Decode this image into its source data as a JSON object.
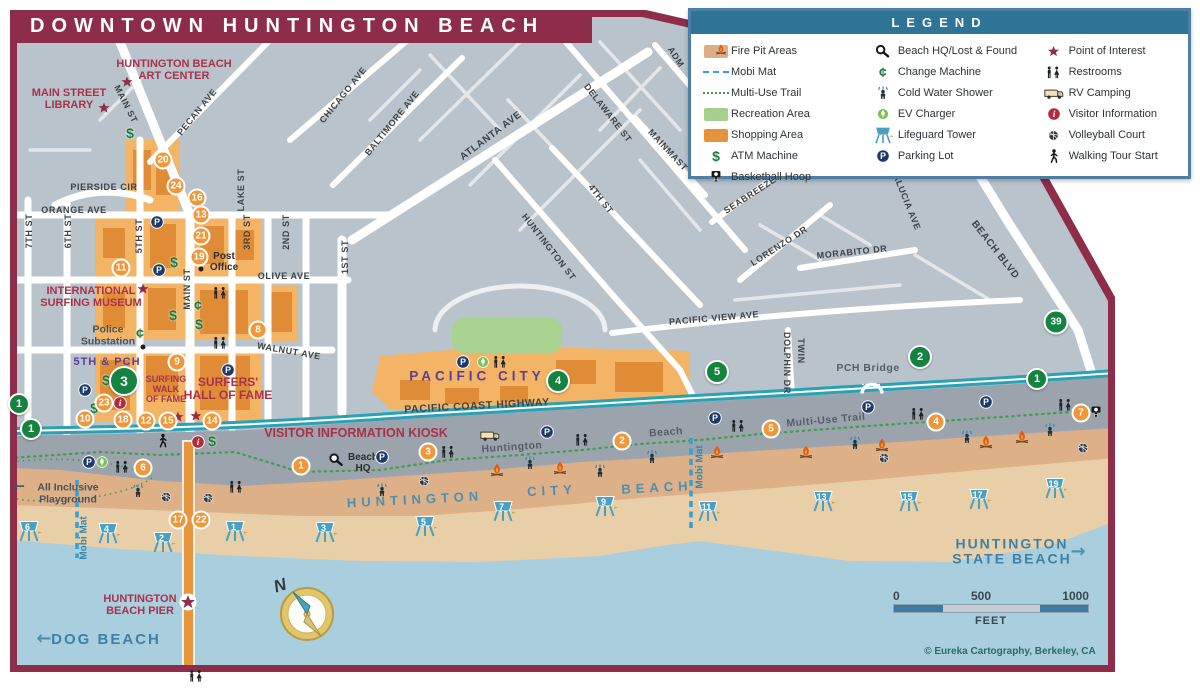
{
  "title": "DOWNTOWN HUNTINGTON BEACH",
  "legend": {
    "title": "LEGEND",
    "columns": [
      [
        {
          "icon": "sw-fire",
          "label": "Fire Pit Areas"
        },
        {
          "icon": "ln-mobi",
          "label": "Mobi Mat"
        },
        {
          "icon": "ln-trail",
          "label": "Multi-Use Trail"
        },
        {
          "icon": "sw-rec",
          "label": "Recreation Area"
        },
        {
          "icon": "sw-shop",
          "label": "Shopping Area"
        },
        {
          "icon": "atm",
          "label": "ATM Machine"
        },
        {
          "icon": "bb",
          "label": "Basketball Hoop"
        }
      ],
      [
        {
          "icon": "hq",
          "label": "Beach HQ/Lost & Found"
        },
        {
          "icon": "cent",
          "label": "Change Machine"
        },
        {
          "icon": "shower",
          "label": "Cold Water Shower"
        },
        {
          "icon": "ev",
          "label": "EV Charger"
        },
        {
          "icon": "tower",
          "label": "Lifeguard Tower"
        },
        {
          "icon": "p",
          "label": "Parking Lot"
        }
      ],
      [
        {
          "icon": "star",
          "label": "Point of Interest"
        },
        {
          "icon": "wc",
          "label": "Restrooms"
        },
        {
          "icon": "rv",
          "label": "RV Camping"
        },
        {
          "icon": "info",
          "label": "Visitor Information"
        },
        {
          "icon": "vb",
          "label": "Volleyball Court"
        },
        {
          "icon": "walk",
          "label": "Walking Tour Start"
        }
      ]
    ]
  },
  "compass": {
    "label": "N"
  },
  "scale_bar": {
    "t0": "0",
    "t500": "500",
    "t1000": "1000",
    "unit": "FEET"
  },
  "copyright": "© Eureka Cartography, Berkeley, CA",
  "map": {
    "street_labels": [
      {
        "text": "PIERSIDE CIR",
        "x": 104,
        "y": 187,
        "rot": 0
      },
      {
        "text": "ORANGE AVE",
        "x": 74,
        "y": 210,
        "rot": 0
      },
      {
        "text": "OLIVE AVE",
        "x": 284,
        "y": 276,
        "rot": 0
      },
      {
        "text": "WALNUT AVE",
        "x": 289,
        "y": 351,
        "rot": 10
      },
      {
        "text": "7TH ST",
        "x": 29,
        "y": 231,
        "rot": -90
      },
      {
        "text": "6TH ST",
        "x": 68,
        "y": 231,
        "rot": -90
      },
      {
        "text": "5TH ST",
        "x": 139,
        "y": 236,
        "rot": -90
      },
      {
        "text": "MAIN ST",
        "x": 187,
        "y": 289,
        "rot": -90
      },
      {
        "text": "LAKE ST",
        "x": 241,
        "y": 190,
        "rot": -90
      },
      {
        "text": "3RD ST",
        "x": 247,
        "y": 232,
        "rot": -90
      },
      {
        "text": "2ND ST",
        "x": 286,
        "y": 232,
        "rot": -90
      },
      {
        "text": "1ST ST",
        "x": 345,
        "y": 257,
        "rot": -90
      },
      {
        "text": "MAIN ST",
        "x": 126,
        "y": 104,
        "rot": 63
      },
      {
        "text": "PECAN AVE",
        "x": 197,
        "y": 112,
        "rot": -51
      },
      {
        "text": "CHICAGO AVE",
        "x": 343,
        "y": 95,
        "rot": -51
      },
      {
        "text": "BALTIMORE AVE",
        "x": 392,
        "y": 123,
        "rot": -51
      },
      {
        "text": "ATLANTA AVE",
        "x": 491,
        "y": 136,
        "rot": -37,
        "fs": 10
      },
      {
        "text": "DELAWARE ST",
        "x": 608,
        "y": 113,
        "rot": 52
      },
      {
        "text": "4TH ST",
        "x": 601,
        "y": 199,
        "rot": 52
      },
      {
        "text": "HUNTINGTON ST",
        "x": 549,
        "y": 247,
        "rot": 52
      },
      {
        "text": "MAINMAST",
        "x": 668,
        "y": 150,
        "rot": 47
      },
      {
        "text": "ADM",
        "x": 676,
        "y": 57,
        "rot": 57
      },
      {
        "text": "SEABREEZE",
        "x": 750,
        "y": 195,
        "rot": -33
      },
      {
        "text": "LORENZO DR",
        "x": 779,
        "y": 246,
        "rot": -33
      },
      {
        "text": "MORABITO DR",
        "x": 852,
        "y": 252,
        "rot": -6
      },
      {
        "text": "ALUCIA AVE",
        "x": 907,
        "y": 202,
        "rot": 68
      },
      {
        "text": "BEACH BLVD",
        "x": 995,
        "y": 250,
        "rot": 52,
        "fs": 10
      },
      {
        "text": "PACIFIC VIEW AVE",
        "x": 714,
        "y": 318,
        "rot": -5
      },
      {
        "text": "DOLPHIN DR",
        "x": 787,
        "y": 363,
        "rot": 90
      },
      {
        "text": "TWIN",
        "x": 801,
        "y": 351,
        "rot": 90
      },
      {
        "text": "PACIFIC COAST HIGHWAY",
        "x": 477,
        "y": 406,
        "rot": -3,
        "fs": 10.5
      }
    ],
    "place_labels": [
      {
        "text": "HUNTINGTON BEACH\nART CENTER",
        "x": 174,
        "y": 70,
        "cls": "pl-maroon",
        "fs": 11
      },
      {
        "text": "MAIN STREET\nLIBRARY",
        "x": 69,
        "y": 99,
        "cls": "pl-maroon",
        "fs": 11
      },
      {
        "text": "INTERNATIONAL\nSURFING MUSEUM",
        "x": 91,
        "y": 297,
        "cls": "pl-maroon",
        "fs": 11
      },
      {
        "text": "5TH & PCH",
        "x": 107,
        "y": 362,
        "cls": "pl-purple",
        "fs": 11
      },
      {
        "text": "SURFING\nWALK\nOF FAME",
        "x": 166,
        "y": 390,
        "cls": "pl-maroon",
        "fs": 9
      },
      {
        "text": "SURFERS'\nHALL OF FAME",
        "x": 228,
        "y": 389,
        "cls": "pl-maroon",
        "fs": 12
      },
      {
        "text": "VISITOR INFORMATION KIOSK",
        "x": 356,
        "y": 434,
        "cls": "pl-maroon",
        "fs": 12.5
      },
      {
        "text": "HUNTINGTON\nBEACH PIER",
        "x": 140,
        "y": 605,
        "cls": "pl-maroon",
        "fs": 11
      },
      {
        "text": "PACIFIC CITY",
        "x": 477,
        "y": 377,
        "cls": "pl-pc",
        "fs": 13.5
      },
      {
        "text": "Post\nOffice",
        "x": 224,
        "y": 262,
        "cls": "pl-black",
        "fs": 10
      },
      {
        "text": "Police\nSubstation",
        "x": 108,
        "y": 336,
        "cls": "pl-gray",
        "fs": 10.5
      },
      {
        "text": "Beach\nHQ",
        "x": 363,
        "y": 463,
        "cls": "pl-black",
        "fs": 10
      },
      {
        "text": "All Inclusive\nPlayground",
        "x": 68,
        "y": 494,
        "cls": "pl-gray",
        "fs": 10.5
      },
      {
        "text": "PCH Bridge",
        "x": 868,
        "y": 369,
        "cls": "pl-trail",
        "fs": 10.5
      },
      {
        "text": "Huntington",
        "x": 512,
        "y": 448,
        "cls": "pl-trail",
        "fs": 10.5,
        "rot": -4
      },
      {
        "text": "Beach",
        "x": 666,
        "y": 433,
        "cls": "pl-trail",
        "fs": 10.5,
        "rot": -4
      },
      {
        "text": "Multi-Use Trail",
        "x": 826,
        "y": 421,
        "cls": "pl-trail",
        "fs": 10.5,
        "rot": -5
      },
      {
        "text": "Mobi Mat",
        "x": 84,
        "y": 538,
        "cls": "pl-mobi",
        "fs": 10,
        "rot": -90
      },
      {
        "text": "Mobi Mat",
        "x": 700,
        "y": 467,
        "cls": "pl-mobi",
        "fs": 10,
        "rot": -90
      },
      {
        "text": "DOG BEACH",
        "x": 106,
        "y": 640,
        "cls": "pl-bluebig",
        "fs": 15
      },
      {
        "text": "HUNTINGTON\nSTATE BEACH",
        "x": 1012,
        "y": 552,
        "cls": "pl-bluebig",
        "fs": 14
      },
      {
        "text": "HUNTINGTON",
        "x": 415,
        "y": 500,
        "cls": "pl-bluebeach",
        "fs": 13,
        "rot": -3
      },
      {
        "text": "CITY",
        "x": 552,
        "y": 491,
        "cls": "pl-bluebeach",
        "fs": 13,
        "rot": -3
      },
      {
        "text": "BEACH",
        "x": 657,
        "y": 488,
        "cls": "pl-bluebeach",
        "fs": 13,
        "rot": -3
      },
      {
        "text": "←",
        "x": 19,
        "y": 487,
        "cls": "pl-arrow-gray",
        "fs": 14
      },
      {
        "text": "←",
        "x": 44,
        "y": 639,
        "cls": "pl-arrow-blue",
        "fs": 18
      },
      {
        "text": "→",
        "x": 1078,
        "y": 552,
        "cls": "pl-arrow-blue",
        "fs": 18
      }
    ],
    "green_badges": [
      {
        "n": "1",
        "x": 19,
        "y": 404,
        "d": 22
      },
      {
        "n": "1",
        "x": 31,
        "y": 429,
        "d": 22
      },
      {
        "n": "3",
        "x": 124,
        "y": 381,
        "d": 30
      },
      {
        "n": "4",
        "x": 558,
        "y": 381,
        "d": 24
      },
      {
        "n": "5",
        "x": 717,
        "y": 372,
        "d": 24
      },
      {
        "n": "2",
        "x": 920,
        "y": 357,
        "d": 24
      },
      {
        "n": "39",
        "x": 1056,
        "y": 322,
        "d": 25
      },
      {
        "n": "1",
        "x": 1037,
        "y": 379,
        "d": 22
      }
    ],
    "orange_markers": [
      {
        "n": "20",
        "x": 163,
        "y": 160
      },
      {
        "n": "24",
        "x": 176,
        "y": 186
      },
      {
        "n": "16",
        "x": 197,
        "y": 198
      },
      {
        "n": "13",
        "x": 201,
        "y": 215
      },
      {
        "n": "21",
        "x": 201,
        "y": 236
      },
      {
        "n": "19",
        "x": 199,
        "y": 257
      },
      {
        "n": "11",
        "x": 121,
        "y": 268
      },
      {
        "n": "8",
        "x": 258,
        "y": 330
      },
      {
        "n": "9",
        "x": 177,
        "y": 362
      },
      {
        "n": "23",
        "x": 104,
        "y": 403
      },
      {
        "n": "10",
        "x": 85,
        "y": 419
      },
      {
        "n": "18",
        "x": 123,
        "y": 420
      },
      {
        "n": "12",
        "x": 146,
        "y": 421
      },
      {
        "n": "15",
        "x": 168,
        "y": 421
      },
      {
        "n": "14",
        "x": 212,
        "y": 421
      },
      {
        "n": "17",
        "x": 178,
        "y": 520
      },
      {
        "n": "22",
        "x": 201,
        "y": 520
      },
      {
        "n": "6",
        "x": 143,
        "y": 468
      },
      {
        "n": "1",
        "x": 301,
        "y": 466
      },
      {
        "n": "3",
        "x": 428,
        "y": 452
      },
      {
        "n": "2",
        "x": 622,
        "y": 441
      },
      {
        "n": "5",
        "x": 771,
        "y": 429
      },
      {
        "n": "4",
        "x": 936,
        "y": 422
      },
      {
        "n": "7",
        "x": 1081,
        "y": 413
      }
    ],
    "lifeguard_towers": [
      {
        "n": "6",
        "x": 29,
        "y": 532
      },
      {
        "n": "4",
        "x": 108,
        "y": 534
      },
      {
        "n": "2",
        "x": 163,
        "y": 543
      },
      {
        "n": "1",
        "x": 235,
        "y": 532
      },
      {
        "n": "3",
        "x": 325,
        "y": 533
      },
      {
        "n": "5",
        "x": 425,
        "y": 527
      },
      {
        "n": "7",
        "x": 503,
        "y": 512
      },
      {
        "n": "9",
        "x": 605,
        "y": 507
      },
      {
        "n": "11",
        "x": 708,
        "y": 512
      },
      {
        "n": "13",
        "x": 823,
        "y": 502
      },
      {
        "n": "15",
        "x": 909,
        "y": 502
      },
      {
        "n": "17",
        "x": 979,
        "y": 500
      },
      {
        "n": "19",
        "x": 1055,
        "y": 489
      }
    ],
    "icons": [
      {
        "t": "star",
        "x": 127,
        "y": 82
      },
      {
        "t": "star",
        "x": 104,
        "y": 108
      },
      {
        "t": "star",
        "x": 143,
        "y": 289
      },
      {
        "t": "star",
        "x": 178,
        "y": 417
      },
      {
        "t": "star",
        "x": 196,
        "y": 416
      },
      {
        "t": "starring",
        "x": 188,
        "y": 602
      },
      {
        "t": "p",
        "x": 157,
        "y": 222
      },
      {
        "t": "p",
        "x": 159,
        "y": 270
      },
      {
        "t": "p",
        "x": 228,
        "y": 370
      },
      {
        "t": "p",
        "x": 85,
        "y": 390
      },
      {
        "t": "p",
        "x": 89,
        "y": 462
      },
      {
        "t": "p",
        "x": 382,
        "y": 457
      },
      {
        "t": "p",
        "x": 463,
        "y": 362
      },
      {
        "t": "p",
        "x": 547,
        "y": 432
      },
      {
        "t": "p",
        "x": 715,
        "y": 418
      },
      {
        "t": "p",
        "x": 868,
        "y": 407
      },
      {
        "t": "p",
        "x": 986,
        "y": 402
      },
      {
        "t": "atm",
        "x": 130,
        "y": 133
      },
      {
        "t": "atm",
        "x": 174,
        "y": 262
      },
      {
        "t": "atm",
        "x": 173,
        "y": 315
      },
      {
        "t": "atm",
        "x": 199,
        "y": 324
      },
      {
        "t": "atm",
        "x": 106,
        "y": 380
      },
      {
        "t": "atm",
        "x": 94,
        "y": 408
      },
      {
        "t": "atm",
        "x": 212,
        "y": 441
      },
      {
        "t": "cent",
        "x": 140,
        "y": 333
      },
      {
        "t": "cent",
        "x": 198,
        "y": 305
      },
      {
        "t": "wc",
        "x": 220,
        "y": 293
      },
      {
        "t": "wc",
        "x": 220,
        "y": 343
      },
      {
        "t": "wc",
        "x": 500,
        "y": 362
      },
      {
        "t": "wc",
        "x": 122,
        "y": 467
      },
      {
        "t": "wc",
        "x": 236,
        "y": 487
      },
      {
        "t": "wc",
        "x": 448,
        "y": 452
      },
      {
        "t": "wc",
        "x": 582,
        "y": 440
      },
      {
        "t": "wc",
        "x": 738,
        "y": 426
      },
      {
        "t": "wc",
        "x": 918,
        "y": 414
      },
      {
        "t": "wc",
        "x": 1065,
        "y": 405
      },
      {
        "t": "wc",
        "x": 196,
        "y": 676
      },
      {
        "t": "shower",
        "x": 138,
        "y": 491
      },
      {
        "t": "shower",
        "x": 382,
        "y": 490
      },
      {
        "t": "shower",
        "x": 530,
        "y": 463
      },
      {
        "t": "shower",
        "x": 600,
        "y": 471
      },
      {
        "t": "shower",
        "x": 652,
        "y": 457
      },
      {
        "t": "shower",
        "x": 855,
        "y": 443
      },
      {
        "t": "shower",
        "x": 967,
        "y": 437
      },
      {
        "t": "shower",
        "x": 1050,
        "y": 430
      },
      {
        "t": "fire",
        "x": 497,
        "y": 470
      },
      {
        "t": "fire",
        "x": 560,
        "y": 468
      },
      {
        "t": "fire",
        "x": 717,
        "y": 452
      },
      {
        "t": "fire",
        "x": 806,
        "y": 452
      },
      {
        "t": "fire",
        "x": 882,
        "y": 445
      },
      {
        "t": "fire",
        "x": 986,
        "y": 442
      },
      {
        "t": "fire",
        "x": 1022,
        "y": 437
      },
      {
        "t": "vb",
        "x": 166,
        "y": 497
      },
      {
        "t": "vb",
        "x": 208,
        "y": 498
      },
      {
        "t": "vb",
        "x": 424,
        "y": 481
      },
      {
        "t": "vb",
        "x": 884,
        "y": 458
      },
      {
        "t": "vb",
        "x": 1083,
        "y": 448
      },
      {
        "t": "bb",
        "x": 1096,
        "y": 413
      },
      {
        "t": "rv",
        "x": 490,
        "y": 435
      },
      {
        "t": "ev",
        "x": 102,
        "y": 462
      },
      {
        "t": "ev",
        "x": 483,
        "y": 362
      },
      {
        "t": "info",
        "x": 120,
        "y": 403
      },
      {
        "t": "info",
        "x": 198,
        "y": 442
      },
      {
        "t": "hq",
        "x": 336,
        "y": 460
      },
      {
        "t": "walk",
        "x": 163,
        "y": 441
      },
      {
        "t": "dot",
        "x": 201,
        "y": 269
      },
      {
        "t": "dot",
        "x": 143,
        "y": 347
      },
      {
        "t": "bridge",
        "x": 872,
        "y": 388
      }
    ]
  }
}
